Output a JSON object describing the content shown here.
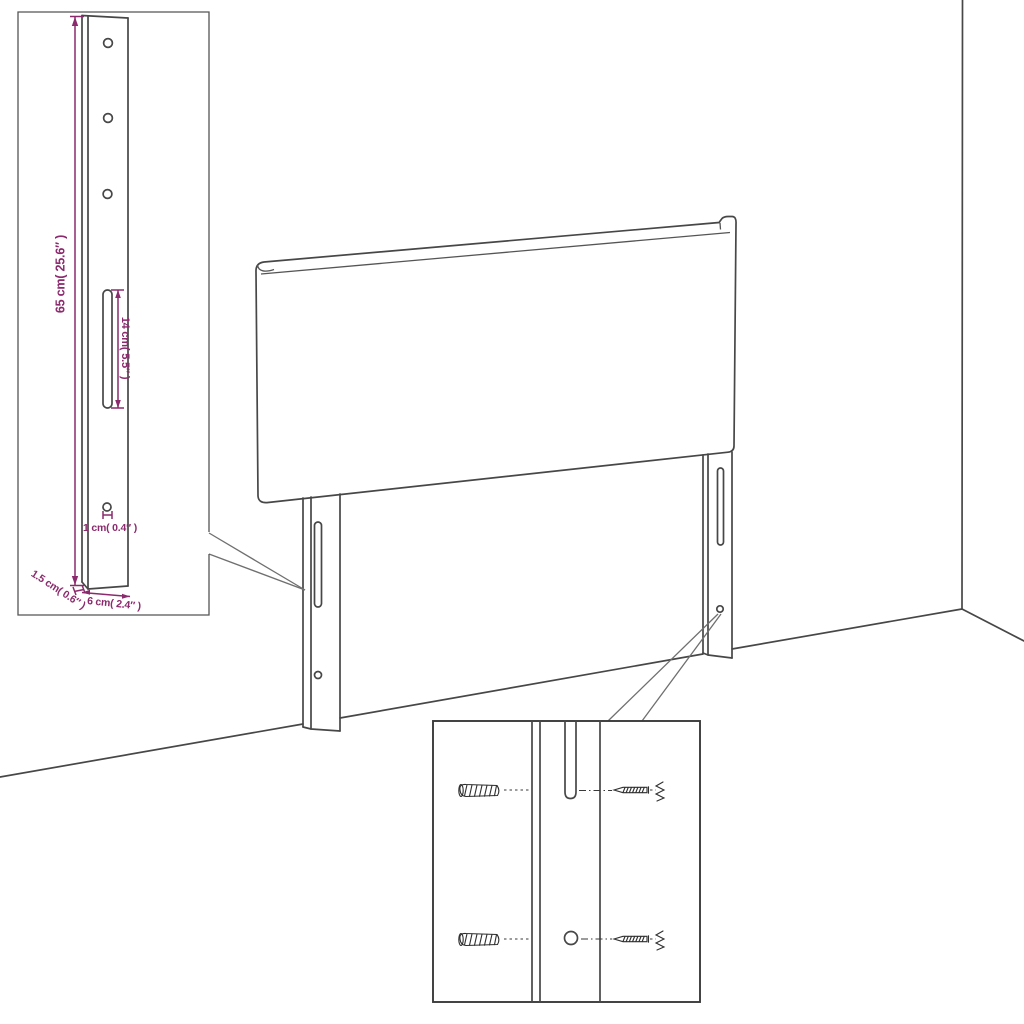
{
  "diagram": {
    "kind": "furniture-dimension-diagram",
    "subject": "upholstered headboard with two mounting legs shown against a room corner",
    "colors": {
      "background": "#ffffff",
      "line": "#474747",
      "dimension_accent": "#8b2a6d"
    },
    "dimensions": {
      "height": "65 cm( 25.6″ )",
      "slot_length": "14 cm( 5.5″ )",
      "hole": "1 cm( 0.4″ )",
      "thickness": "1.5 cm( 0.6″ )",
      "width": "6 cm( 2.4″ )"
    },
    "leg_detail_inset": {
      "top_holes_count": 3,
      "slot_count": 1,
      "bottom_hole_count": 1
    },
    "mounting_detail_inset": {
      "wall_anchors_count": 2,
      "screws_count": 2,
      "slot_count": 1,
      "hole_count": 1
    },
    "scene": {
      "legs_count": 2,
      "wall_corner_shown": true
    }
  }
}
